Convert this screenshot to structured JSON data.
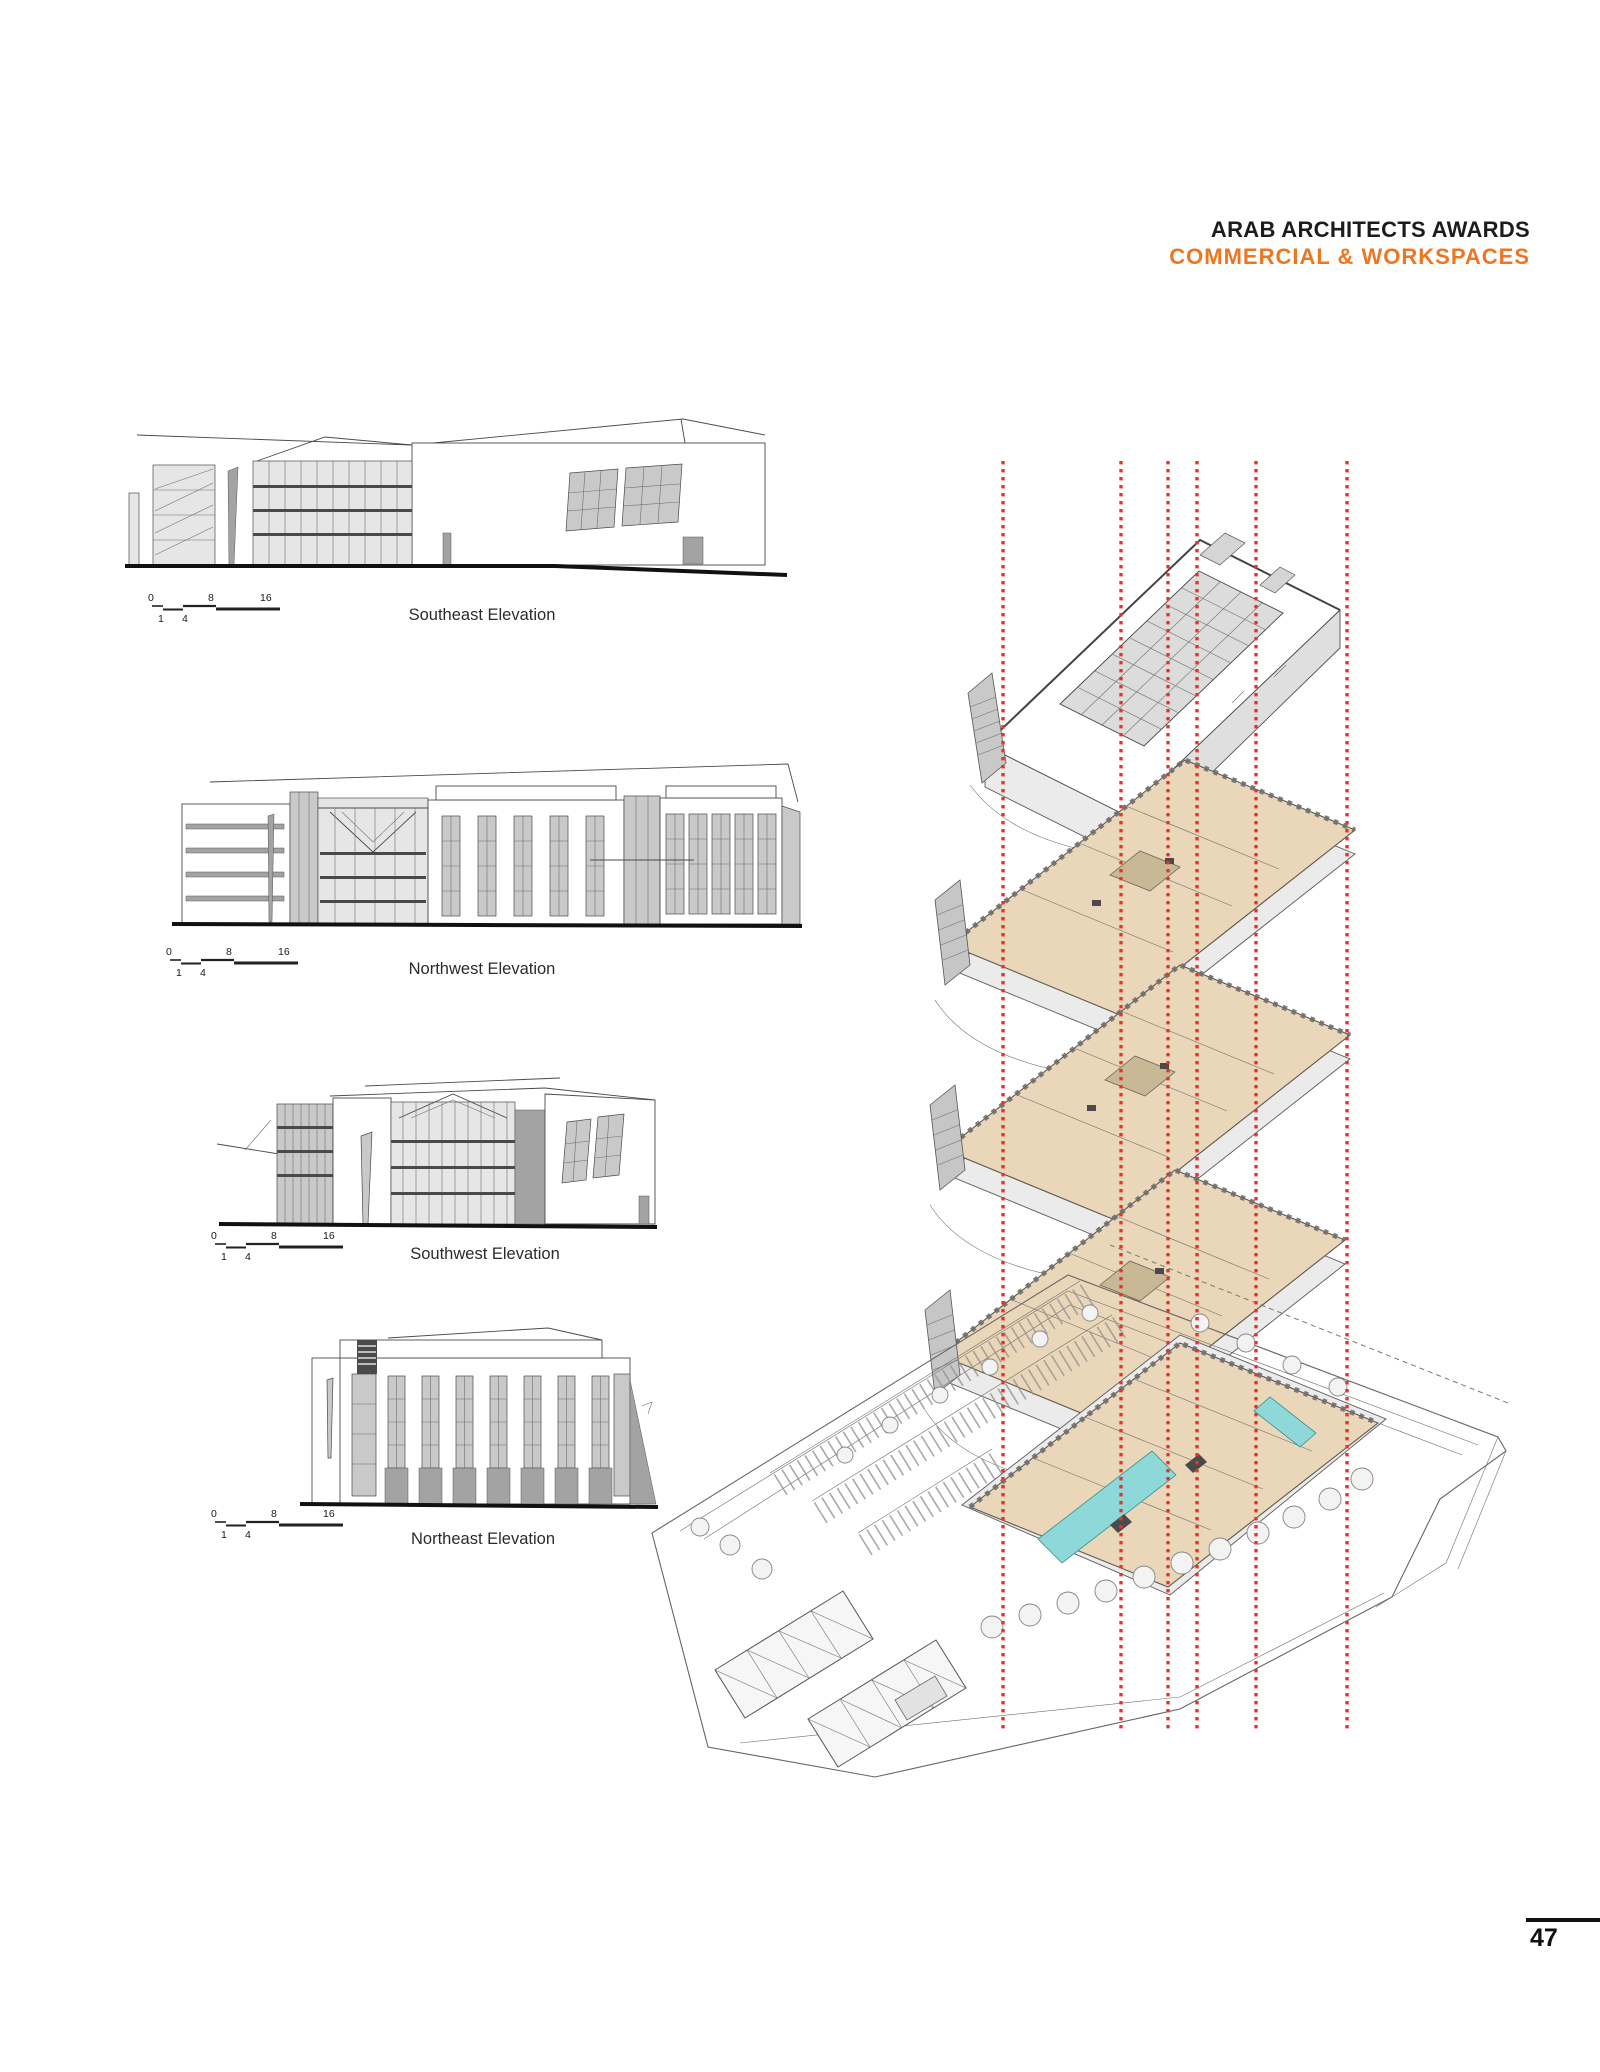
{
  "header": {
    "title": "ARAB ARCHITECTS AWARDS",
    "subtitle": "COMMERCIAL & WORKSPACES"
  },
  "elevations": [
    {
      "id": "southeast",
      "label": "Southeast Elevation",
      "scale": {
        "top": [
          "0",
          "8",
          "16"
        ],
        "bottom": [
          "1",
          "4"
        ]
      }
    },
    {
      "id": "northwest",
      "label": "Northwest Elevation",
      "scale": {
        "top": [
          "0",
          "8",
          "16"
        ],
        "bottom": [
          "1",
          "4"
        ]
      }
    },
    {
      "id": "southwest",
      "label": "Southwest Elevation",
      "scale": {
        "top": [
          "0",
          "8",
          "16"
        ],
        "bottom": [
          "1",
          "4"
        ]
      }
    },
    {
      "id": "northeast",
      "label": "Northeast Elevation",
      "scale": {
        "top": [
          "0",
          "8",
          "16"
        ],
        "bottom": [
          "1",
          "4"
        ]
      }
    }
  ],
  "footer": {
    "page_number": "47"
  },
  "colors": {
    "accent_orange": "#ee7623",
    "guide_red": "#e5352b",
    "floor_tan": "#ead7ba",
    "pool_teal": "#8fd8da"
  }
}
